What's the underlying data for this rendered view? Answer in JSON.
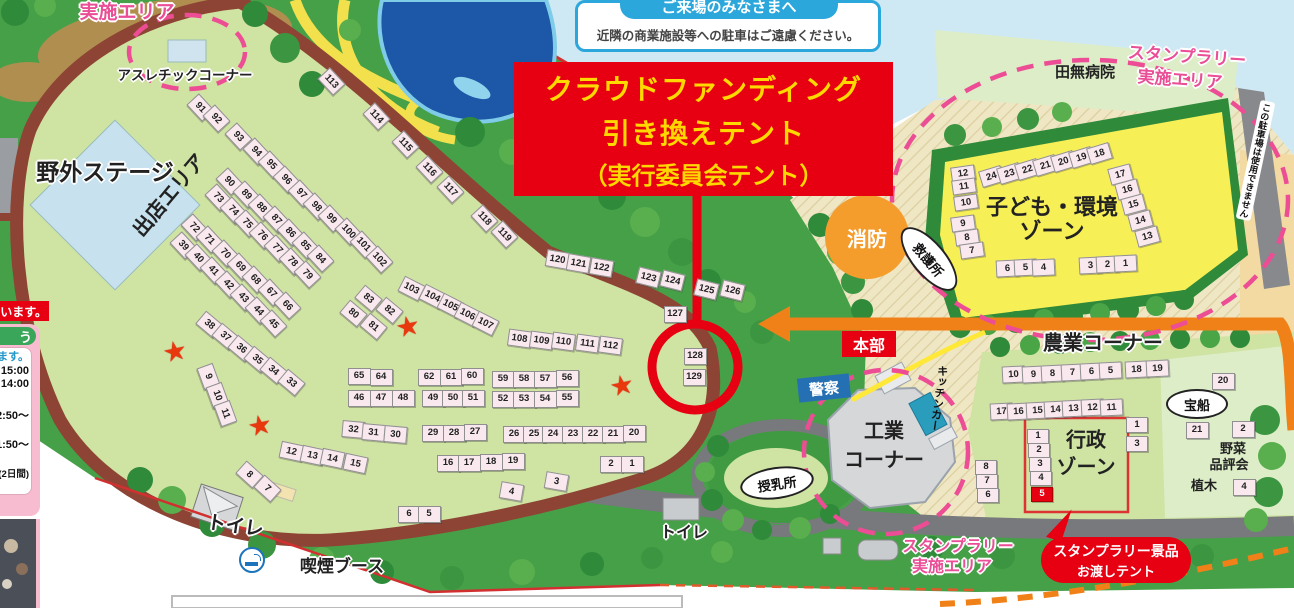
{
  "notice": {
    "title": "ご来場のみなさまへ",
    "body": "近隣の商業施設等への駐車はご遠慮ください。"
  },
  "banner": {
    "line1": "クラウドファンディング",
    "line2": "引き換えテント",
    "line3": "（実行委員会テント）"
  },
  "labels": {
    "impl_area_tl": "実施エリア",
    "athletic_corner": "アスレチックコーナー",
    "outdoor_stage": "野外ステージ",
    "shop_area": "出店エリア",
    "hospital": "田無病院",
    "stamp_rally_tr1": "スタンプラリー",
    "stamp_rally_tr2": "実施エリア",
    "kids_zone1": "子ども・環境",
    "kids_zone2": "ゾーン",
    "parking_note": "この駐車場は使用できません",
    "fire": "消防",
    "first_aid": "救護所",
    "headquarters": "本部",
    "police": "警察",
    "agriculture_corner": "農業コーナー",
    "industry1": "工業",
    "industry2": "コーナー",
    "kitchen_car": "キッチンカー",
    "nursing_room": "授乳所",
    "admin_zone1": "行政",
    "admin_zone2": "ゾーン",
    "treasure_ship": "宝船",
    "vegetable1": "野菜",
    "vegetable2": "品評会",
    "planting": "植木",
    "toilet_left": "トイレ",
    "toilet_mid": "トイレ",
    "smoking_booth": "喫煙ブース",
    "stamp_rally_b1": "スタンプラリー",
    "stamp_rally_b2": "実施エリア",
    "gift_tent1": "スタンプラリー景品",
    "gift_tent2": "お渡しテント"
  },
  "left_panel": {
    "strip": "います。",
    "header": "う",
    "rows": [
      {
        "t": "ます。",
        "c": "blue",
        "gap": 0
      },
      {
        "t": "15:00",
        "gap": 2
      },
      {
        "t": "14:00",
        "gap": 1
      },
      {
        "t": "2:50～",
        "gap": 20
      },
      {
        "t": "1:50～",
        "gap": 17
      },
      {
        "t": "(2日間)",
        "small": true,
        "gap": 18
      }
    ]
  },
  "stars": [
    [
      175,
      352
    ],
    [
      260,
      426
    ],
    [
      408,
      327
    ],
    [
      622,
      386
    ]
  ],
  "booths": {
    "groups": [
      {
        "rot": 47,
        "items": [
          [
            91,
            199,
            106
          ],
          [
            92,
            215,
            117
          ],
          [
            93,
            237,
            135
          ],
          [
            94,
            255,
            150
          ],
          [
            95,
            270,
            163
          ],
          [
            96,
            285,
            178
          ],
          [
            97,
            300,
            192
          ],
          [
            98,
            315,
            205
          ],
          [
            99,
            330,
            217
          ],
          [
            100,
            347,
            230
          ],
          [
            101,
            362,
            243
          ],
          [
            102,
            378,
            258
          ]
        ]
      },
      {
        "rot": 47,
        "items": [
          [
            90,
            228,
            180
          ],
          [
            89,
            245,
            193
          ],
          [
            88,
            260,
            206
          ],
          [
            87,
            275,
            218
          ],
          [
            86,
            289,
            231
          ],
          [
            85,
            304,
            244
          ],
          [
            84,
            319,
            257
          ]
        ]
      },
      {
        "rot": 47,
        "items": [
          [
            73,
            217,
            196
          ],
          [
            74,
            232,
            209
          ],
          [
            75,
            246,
            222
          ],
          [
            76,
            261,
            234
          ],
          [
            77,
            276,
            247
          ],
          [
            78,
            291,
            260
          ],
          [
            79,
            306,
            273
          ]
        ]
      },
      {
        "rot": 47,
        "items": [
          [
            72,
            193,
            226
          ],
          [
            71,
            208,
            238
          ],
          [
            70,
            224,
            252
          ],
          [
            69,
            239,
            265
          ],
          [
            68,
            254,
            278
          ],
          [
            67,
            270,
            291
          ],
          [
            66,
            286,
            304
          ]
        ]
      },
      {
        "rot": 47,
        "items": [
          [
            39,
            182,
            244
          ],
          [
            40,
            197,
            256
          ],
          [
            41,
            212,
            269
          ],
          [
            42,
            227,
            283
          ],
          [
            43,
            242,
            296
          ],
          [
            44,
            257,
            309
          ],
          [
            45,
            272,
            322
          ]
        ]
      },
      {
        "rot": 40,
        "items": [
          [
            38,
            208,
            323
          ],
          [
            37,
            224,
            335
          ],
          [
            36,
            240,
            347
          ],
          [
            35,
            256,
            358
          ],
          [
            34,
            272,
            369
          ],
          [
            33,
            290,
            381
          ]
        ]
      },
      {
        "rot": 70,
        "items": [
          [
            9,
            207,
            375
          ],
          [
            10,
            216,
            394
          ],
          [
            11,
            224,
            412
          ]
        ]
      },
      {
        "rot": 12,
        "items": [
          [
            12,
            290,
            450
          ],
          [
            13,
            311,
            454
          ],
          [
            14,
            331,
            457
          ],
          [
            15,
            354,
            462
          ]
        ]
      },
      {
        "rot": 42,
        "items": [
          [
            8,
            248,
            473
          ],
          [
            7,
            266,
            487
          ]
        ]
      },
      {
        "rot": 40,
        "items": [
          [
            83,
            367,
            297
          ],
          [
            82,
            388,
            309
          ],
          [
            80,
            352,
            312
          ],
          [
            81,
            372,
            325
          ]
        ]
      },
      {
        "rot": 27,
        "items": [
          [
            103,
            410,
            287
          ],
          [
            104,
            431,
            295
          ],
          [
            105,
            449,
            304
          ],
          [
            106,
            466,
            313
          ],
          [
            107,
            484,
            322
          ]
        ]
      },
      {
        "rot": 8,
        "items": [
          [
            108,
            518,
            337
          ],
          [
            109,
            540,
            339
          ],
          [
            110,
            562,
            340
          ],
          [
            111,
            586,
            342
          ],
          [
            112,
            609,
            344
          ]
        ]
      },
      {
        "rot": 0,
        "items": [
          [
            65,
            358,
            375
          ],
          [
            64,
            380,
            376
          ],
          [
            46,
            358,
            397
          ],
          [
            47,
            380,
            397
          ],
          [
            48,
            402,
            397
          ]
        ]
      },
      {
        "rot": 0,
        "items": [
          [
            62,
            428,
            376
          ],
          [
            61,
            450,
            376
          ],
          [
            60,
            471,
            375
          ],
          [
            49,
            432,
            397
          ],
          [
            50,
            452,
            397
          ],
          [
            51,
            472,
            397
          ]
        ]
      },
      {
        "rot": 0,
        "items": [
          [
            59,
            502,
            378
          ],
          [
            58,
            523,
            378
          ],
          [
            57,
            544,
            378
          ],
          [
            56,
            566,
            377
          ],
          [
            52,
            502,
            398
          ],
          [
            53,
            523,
            398
          ],
          [
            54,
            544,
            398
          ],
          [
            55,
            566,
            397
          ]
        ]
      },
      {
        "rot": 5,
        "items": [
          [
            32,
            352,
            428
          ],
          [
            31,
            372,
            431
          ],
          [
            30,
            394,
            433
          ]
        ]
      },
      {
        "rot": 0,
        "items": [
          [
            29,
            432,
            432
          ],
          [
            28,
            453,
            432
          ],
          [
            27,
            474,
            431
          ]
        ]
      },
      {
        "rot": 0,
        "items": [
          [
            26,
            513,
            433
          ],
          [
            25,
            533,
            433
          ],
          [
            24,
            552,
            433
          ],
          [
            23,
            572,
            433
          ],
          [
            22,
            592,
            433
          ],
          [
            21,
            612,
            433
          ],
          [
            20,
            633,
            432
          ]
        ]
      },
      {
        "rot": 0,
        "items": [
          [
            16,
            447,
            462
          ],
          [
            17,
            468,
            462
          ],
          [
            18,
            490,
            461
          ],
          [
            19,
            512,
            460
          ]
        ]
      },
      {
        "rot": 0,
        "items": [
          [
            2,
            610,
            463
          ],
          [
            1,
            631,
            463
          ]
        ]
      },
      {
        "rot": 10,
        "items": [
          [
            3,
            555,
            480
          ]
        ]
      },
      {
        "rot": 10,
        "items": [
          [
            4,
            510,
            490
          ]
        ]
      },
      {
        "rot": 0,
        "items": [
          [
            6,
            408,
            513
          ],
          [
            5,
            428,
            513
          ]
        ]
      },
      {
        "rot": 47,
        "items": [
          [
            113,
            330,
            80
          ],
          [
            114,
            375,
            115
          ],
          [
            115,
            404,
            143
          ],
          [
            116,
            428,
            168
          ],
          [
            117,
            449,
            188
          ],
          [
            118,
            483,
            217
          ],
          [
            119,
            503,
            233
          ]
        ]
      },
      {
        "rot": 10,
        "items": [
          [
            120,
            556,
            258
          ],
          [
            121,
            577,
            262
          ],
          [
            122,
            600,
            266
          ]
        ]
      },
      {
        "rot": 14,
        "items": [
          [
            123,
            647,
            276
          ],
          [
            124,
            671,
            279
          ]
        ]
      },
      {
        "rot": 14,
        "items": [
          [
            125,
            705,
            288
          ],
          [
            126,
            731,
            289
          ]
        ]
      },
      {
        "rot": 0,
        "items": [
          [
            127,
            674,
            313
          ]
        ]
      },
      {
        "rot": 0,
        "items": [
          [
            128,
            694,
            355
          ],
          [
            129,
            693,
            376
          ]
        ]
      },
      {
        "rot": -17,
        "items": [
          [
            24,
            990,
            175
          ],
          [
            23,
            1008,
            172
          ],
          [
            22,
            1026,
            168
          ],
          [
            21,
            1044,
            164
          ],
          [
            20,
            1062,
            160
          ],
          [
            19,
            1080,
            156
          ],
          [
            18,
            1098,
            152
          ]
        ]
      },
      {
        "rot": -8,
        "w": 22,
        "h": 13,
        "items": [
          [
            12,
            962,
            172
          ],
          [
            11,
            963,
            185
          ],
          [
            10,
            965,
            201
          ]
        ]
      },
      {
        "rot": -8,
        "w": 22,
        "h": 13,
        "items": [
          [
            9,
            962,
            222
          ],
          [
            8,
            966,
            236
          ],
          [
            7,
            971,
            249
          ]
        ]
      },
      {
        "rot": -15,
        "items": [
          [
            17,
            1119,
            173
          ],
          [
            16,
            1126,
            188
          ],
          [
            15,
            1132,
            203
          ],
          [
            14,
            1139,
            219
          ],
          [
            13,
            1146,
            235
          ]
        ]
      },
      {
        "rot": -3,
        "items": [
          [
            6,
            1006,
            267
          ],
          [
            5,
            1024,
            266
          ],
          [
            4,
            1042,
            266
          ]
        ]
      },
      {
        "rot": -3,
        "items": [
          [
            3,
            1089,
            264
          ],
          [
            2,
            1106,
            263
          ],
          [
            1,
            1124,
            262
          ]
        ]
      },
      {
        "rot": -3,
        "items": [
          [
            10,
            1012,
            373
          ],
          [
            9,
            1032,
            373
          ],
          [
            8,
            1051,
            372
          ],
          [
            7,
            1071,
            371
          ],
          [
            6,
            1090,
            370
          ],
          [
            5,
            1109,
            369
          ]
        ]
      },
      {
        "rot": -3,
        "items": [
          [
            18,
            1135,
            368
          ],
          [
            19,
            1156,
            367
          ]
        ]
      },
      {
        "rot": -3,
        "items": [
          [
            17,
            1000,
            410
          ],
          [
            16,
            1017,
            410
          ],
          [
            15,
            1036,
            409
          ],
          [
            14,
            1054,
            408
          ],
          [
            13,
            1072,
            407
          ],
          [
            12,
            1091,
            406
          ],
          [
            11,
            1110,
            406
          ]
        ]
      },
      {
        "rot": 0,
        "w": 20,
        "h": 13,
        "items": [
          [
            1,
            1037,
            435
          ],
          [
            2,
            1038,
            449
          ],
          [
            3,
            1039,
            463
          ],
          [
            4,
            1040,
            477
          ],
          [
            5,
            1041,
            493,
            "red"
          ]
        ]
      },
      {
        "rot": 0,
        "w": 20,
        "h": 14,
        "items": [
          [
            1,
            1136,
            424
          ],
          [
            3,
            1136,
            443
          ]
        ]
      },
      {
        "rot": 0,
        "w": 20,
        "h": 13,
        "items": [
          [
            8,
            985,
            466
          ],
          [
            7,
            986,
            480
          ],
          [
            6,
            987,
            494
          ]
        ]
      },
      {
        "rot": 0,
        "items": [
          [
            20,
            1222,
            380
          ]
        ]
      },
      {
        "rot": 0,
        "items": [
          [
            21,
            1196,
            429
          ],
          [
            2,
            1242,
            428
          ]
        ]
      },
      {
        "rot": 0,
        "items": [
          [
            4,
            1243,
            486
          ]
        ]
      }
    ]
  }
}
